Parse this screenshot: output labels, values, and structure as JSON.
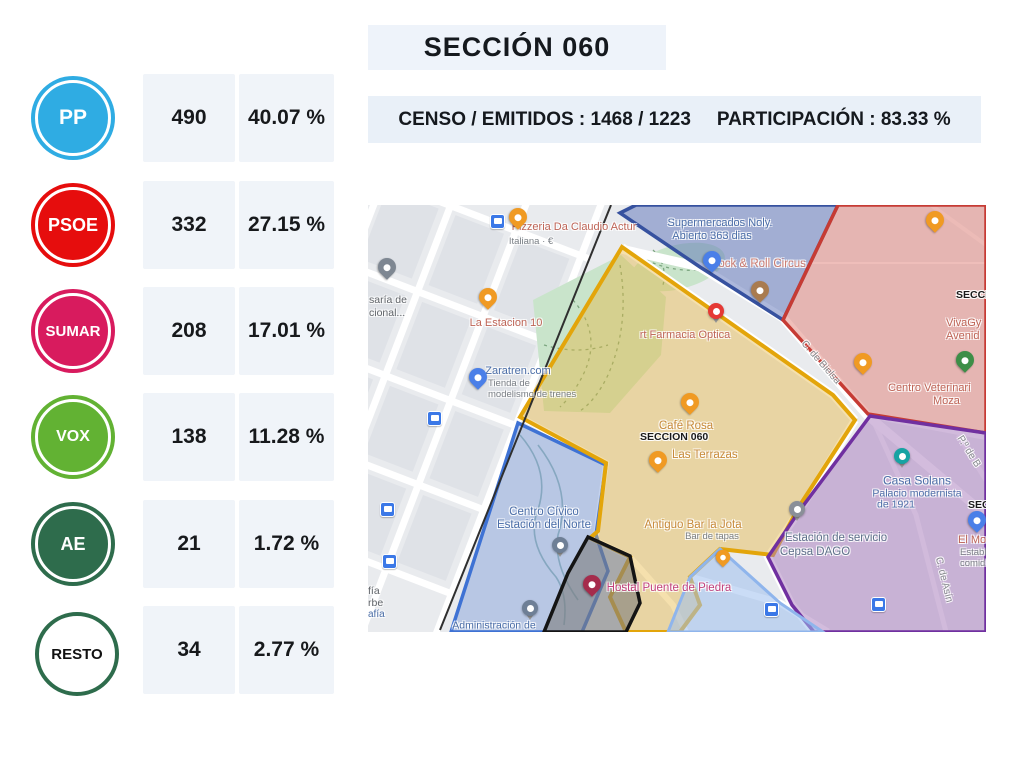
{
  "header": {
    "title": "SECCIÓN 060",
    "censo_emitidos": "CENSO / EMITIDOS : 1468 / 1223",
    "participacion": "PARTICIPACIÓN : 83.33 %"
  },
  "results": [
    {
      "party": "PP",
      "votes": "490",
      "percent": "40.07 %",
      "color": "#2FACE3"
    },
    {
      "party": "PSOE",
      "votes": "332",
      "percent": "27.15 %",
      "color": "#E60D0D"
    },
    {
      "party": "SUMAR",
      "votes": "208",
      "percent": "17.01 %",
      "color": "#D81B5E"
    },
    {
      "party": "VOX",
      "votes": "138",
      "percent": "11.28 %",
      "color": "#62B233"
    },
    {
      "party": "AE",
      "votes": "21",
      "percent": "1.72 %",
      "color": "#2E6C4C"
    },
    {
      "party": "RESTO",
      "votes": "34",
      "percent": "2.77 %",
      "color": "#2E6C4C"
    }
  ],
  "map": {
    "zone_colors": {
      "section_060_border": "#E3A50A",
      "north_zone_border": "#36519F",
      "east_zone_border": "#C63B34",
      "southeast_zone_border": "#7030A0",
      "station_zone_border": "#3E72D4",
      "black_zone_border": "#141414",
      "lightblue_zone_border": "#8FB5EC"
    },
    "icons": {
      "restaurant-pin": "#F09A23",
      "cafe-pin": "#F09A23",
      "bar-pin": "#A97B4F",
      "shopping-pin": "#4A7FE8",
      "pharmacy-pin": "#E53935",
      "park-pin": "#3D8E47",
      "hotel-pin": "#A52C4C",
      "landmark-pin": "#16A3A3",
      "museum-pin": "#6E7F96",
      "gas-station-pin": "#8A8F98",
      "bus-stop-icon": "#3B78E7",
      "generic-poi-pin": "#7E8792"
    },
    "labels": [
      {
        "text": "Pizzeria Da Claudio Actur"
      },
      {
        "text": "Italiana · €"
      },
      {
        "text": "saría de"
      },
      {
        "text": "cional..."
      },
      {
        "text": "La Estacion 10"
      },
      {
        "text": "Zaratren.com"
      },
      {
        "text": "Tienda de"
      },
      {
        "text": "modelismo de trenes"
      },
      {
        "text": "Supermercados Noly."
      },
      {
        "text": "Abierto 363 dias"
      },
      {
        "text": "Rock & Roll Circus"
      },
      {
        "text": "rt Farmacia Optica"
      },
      {
        "text": "SECCIO"
      },
      {
        "text": "VivaGy"
      },
      {
        "text": "Avenid"
      },
      {
        "text": "Centro Veterinari"
      },
      {
        "text": "Moza"
      },
      {
        "text": "Café Rosa"
      },
      {
        "text": "SECCION 060"
      },
      {
        "text": "Las Terrazas"
      },
      {
        "text": "Antiguo Bar la Jota"
      },
      {
        "text": "Bar de tapas"
      },
      {
        "text": "Casa Solans"
      },
      {
        "text": "Palacio modernista"
      },
      {
        "text": "de 1921"
      },
      {
        "text": "Estación de servicio"
      },
      {
        "text": "Cepsa DAGO"
      },
      {
        "text": "Hostal Puente de Piedra"
      },
      {
        "text": "El Mo"
      },
      {
        "text": "Establ"
      },
      {
        "text": "comid"
      },
      {
        "text": "SEC"
      },
      {
        "text": "Centro Cívico"
      },
      {
        "text": "Estación del Norte"
      },
      {
        "text": "Administración de"
      },
      {
        "text": "fía"
      },
      {
        "text": "rbe"
      },
      {
        "text": "afía"
      },
      {
        "text": "C. de Bielsa"
      },
      {
        "text": "C. de Asín"
      },
      {
        "text": "P.º de B"
      }
    ]
  }
}
